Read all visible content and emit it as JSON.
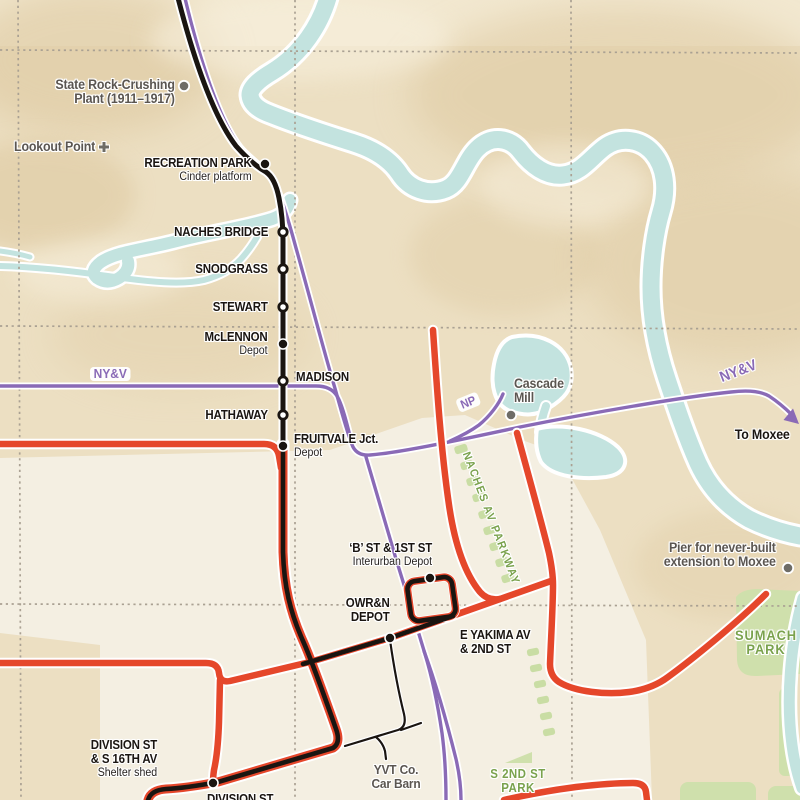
{
  "map": {
    "colors": {
      "red": "#e5472b",
      "black": "#1a1511",
      "purple": "#8a6ab6",
      "river": "#c3e3df",
      "terrain": "#ecdfc2",
      "hill": "#dcc69c",
      "valley": "#f7efdc",
      "city": "#f4efe2",
      "park": "#cfe0ac",
      "park_dash": "#c9dda4",
      "green_text": "#7aa24d",
      "gray_text": "#5b5651",
      "grid": "#aaa193",
      "casing": "#ffffff",
      "gray_marker": "#6e6c66"
    },
    "labels": [
      {
        "name": "label-state-rock-crushing-plant",
        "cls": "place",
        "align": "right",
        "x": 175,
        "y": 78,
        "lines": [
          {
            "t": "State Rock-Crushing"
          },
          {
            "t": "Plant (1911–1917)"
          }
        ]
      },
      {
        "name": "label-lookout-point",
        "cls": "place",
        "align": "right",
        "x": 95,
        "y": 140,
        "lines": [
          {
            "t": "Lookout Point"
          }
        ]
      },
      {
        "name": "label-recreation-park",
        "cls": "station",
        "align": "right",
        "x": 252,
        "y": 156,
        "lines": [
          {
            "t": "RECREATION PARK"
          },
          {
            "t": "Cinder platform",
            "sub": true
          }
        ]
      },
      {
        "name": "label-naches-bridge",
        "cls": "station",
        "align": "right",
        "x": 268,
        "y": 225,
        "lines": [
          {
            "t": "NACHES BRIDGE"
          }
        ]
      },
      {
        "name": "label-snodgrass",
        "cls": "station",
        "align": "right",
        "x": 268,
        "y": 262,
        "lines": [
          {
            "t": "SNODGRASS"
          }
        ]
      },
      {
        "name": "label-stewart",
        "cls": "station",
        "align": "right",
        "x": 268,
        "y": 300,
        "lines": [
          {
            "t": "STEWART"
          }
        ]
      },
      {
        "name": "label-mclennon",
        "cls": "station",
        "align": "right",
        "x": 268,
        "y": 330,
        "lines": [
          {
            "t": "McLENNON"
          },
          {
            "t": "Depot",
            "sub": true
          }
        ]
      },
      {
        "name": "label-madison",
        "cls": "station",
        "align": "left",
        "x": 296,
        "y": 370,
        "lines": [
          {
            "t": "MADISON"
          }
        ]
      },
      {
        "name": "label-hathaway",
        "cls": "station",
        "align": "right",
        "x": 268,
        "y": 408,
        "lines": [
          {
            "t": "HATHAWAY"
          }
        ]
      },
      {
        "name": "label-fruitvale-jct",
        "cls": "station",
        "align": "left",
        "x": 294,
        "y": 432,
        "lines": [
          {
            "t": "FRUITVALE Jct."
          },
          {
            "t": "Depot",
            "sub": true
          }
        ]
      },
      {
        "name": "label-nyv-west",
        "cls": "purlbl pill nohalo",
        "align": "left",
        "x": 90,
        "y": 367,
        "size": 13,
        "lines": [
          {
            "t": "NY&V"
          }
        ]
      },
      {
        "name": "label-np",
        "cls": "purlbl pill nohalo",
        "align": "left",
        "x": 455,
        "y": 400,
        "size": 12,
        "rotate": -22,
        "lines": [
          {
            "t": "NP"
          }
        ]
      },
      {
        "name": "label-nyv-east",
        "cls": "purlbl",
        "align": "left",
        "x": 718,
        "y": 372,
        "size": 15,
        "rotate": -21,
        "lines": [
          {
            "t": "NY&V"
          }
        ]
      },
      {
        "name": "label-to-moxee",
        "cls": "station",
        "align": "right",
        "x": 790,
        "y": 428,
        "size": 13.5,
        "lines": [
          {
            "t": "To Moxee"
          }
        ]
      },
      {
        "name": "label-cascade-mill",
        "cls": "place",
        "align": "left",
        "x": 514,
        "y": 377,
        "lines": [
          {
            "t": "Cascade"
          },
          {
            "t": "Mill"
          }
        ]
      },
      {
        "name": "label-pier-moxee",
        "cls": "place",
        "align": "right",
        "x": 776,
        "y": 541,
        "lines": [
          {
            "t": "Pier for never-built"
          },
          {
            "t": "extension to Moxee"
          }
        ]
      },
      {
        "name": "label-sumach-park",
        "cls": "grnlbl",
        "align": "center",
        "x": 766,
        "y": 628,
        "size": 14,
        "ls": 1,
        "lines": [
          {
            "t": "SUMACH"
          },
          {
            "t": "PARK"
          }
        ]
      },
      {
        "name": "label-s-2nd-st-park",
        "cls": "grnlbl",
        "align": "center",
        "x": 518,
        "y": 767,
        "size": 12.5,
        "ls": 0.5,
        "lines": [
          {
            "t": "S 2ND ST"
          },
          {
            "t": "PARK"
          }
        ]
      },
      {
        "name": "label-naches-av-parkway",
        "cls": "grnlbl",
        "align": "left",
        "x": 472,
        "y": 450,
        "size": 11.5,
        "ls": 1.6,
        "rotate": 69,
        "lines": [
          {
            "t": "NACHES AV PARKWAY"
          }
        ]
      },
      {
        "name": "label-b-st-1st-st",
        "cls": "station",
        "align": "right",
        "x": 432,
        "y": 541,
        "lines": [
          {
            "t": "‘B’ ST & 1ST ST"
          },
          {
            "t": "Interurban Depot",
            "sub": true
          }
        ]
      },
      {
        "name": "label-owrn-depot",
        "cls": "station",
        "align": "right",
        "x": 390,
        "y": 596,
        "lines": [
          {
            "t": "OWR&N"
          },
          {
            "t": "DEPOT"
          }
        ]
      },
      {
        "name": "label-e-yakima-2nd",
        "cls": "station",
        "align": "left",
        "x": 460,
        "y": 628,
        "lines": [
          {
            "t": "E YAKIMA AV"
          },
          {
            "t": "& 2ND ST"
          }
        ]
      },
      {
        "name": "label-division-16th",
        "cls": "station",
        "align": "right",
        "x": 157,
        "y": 738,
        "lines": [
          {
            "t": "DIVISION ST"
          },
          {
            "t": "& S 16TH AV"
          },
          {
            "t": "Shelter shed",
            "sub": true
          }
        ]
      },
      {
        "name": "label-division-st",
        "cls": "station",
        "align": "left",
        "x": 207,
        "y": 792,
        "lines": [
          {
            "t": "DIVISION ST"
          }
        ]
      },
      {
        "name": "label-yvt-car-barn",
        "cls": "place",
        "align": "center",
        "x": 396,
        "y": 763,
        "size": 13,
        "lines": [
          {
            "t": "YVT Co."
          },
          {
            "t": "Car Barn"
          }
        ]
      }
    ],
    "markers": [
      {
        "name": "stop-recreation-park",
        "type": "filled",
        "x": 265,
        "y": 164
      },
      {
        "name": "stop-naches-bridge",
        "type": "open",
        "x": 283,
        "y": 232
      },
      {
        "name": "stop-snodgrass",
        "type": "open",
        "x": 283,
        "y": 269
      },
      {
        "name": "stop-stewart",
        "type": "open",
        "x": 283,
        "y": 307
      },
      {
        "name": "stop-mclennon",
        "type": "filled",
        "x": 283,
        "y": 344
      },
      {
        "name": "stop-madison",
        "type": "open",
        "x": 283,
        "y": 381
      },
      {
        "name": "stop-hathaway",
        "type": "open",
        "x": 283,
        "y": 415
      },
      {
        "name": "stop-fruitvale-jct",
        "type": "filled",
        "x": 283,
        "y": 446
      },
      {
        "name": "stop-b-st-loop",
        "type": "filled",
        "x": 430,
        "y": 578
      },
      {
        "name": "stop-owrn-depot",
        "type": "filled",
        "x": 390,
        "y": 638
      },
      {
        "name": "stop-division-16th",
        "type": "filled",
        "x": 213,
        "y": 783
      },
      {
        "name": "dot-rock-crushing-plant",
        "type": "gray",
        "x": 184,
        "y": 86
      },
      {
        "name": "dot-cascade-mill",
        "type": "gray",
        "x": 511,
        "y": 415
      },
      {
        "name": "dot-pier",
        "type": "gray",
        "x": 788,
        "y": 568
      },
      {
        "name": "cross-lookout-point",
        "type": "cross",
        "x": 104,
        "y": 147
      }
    ]
  }
}
